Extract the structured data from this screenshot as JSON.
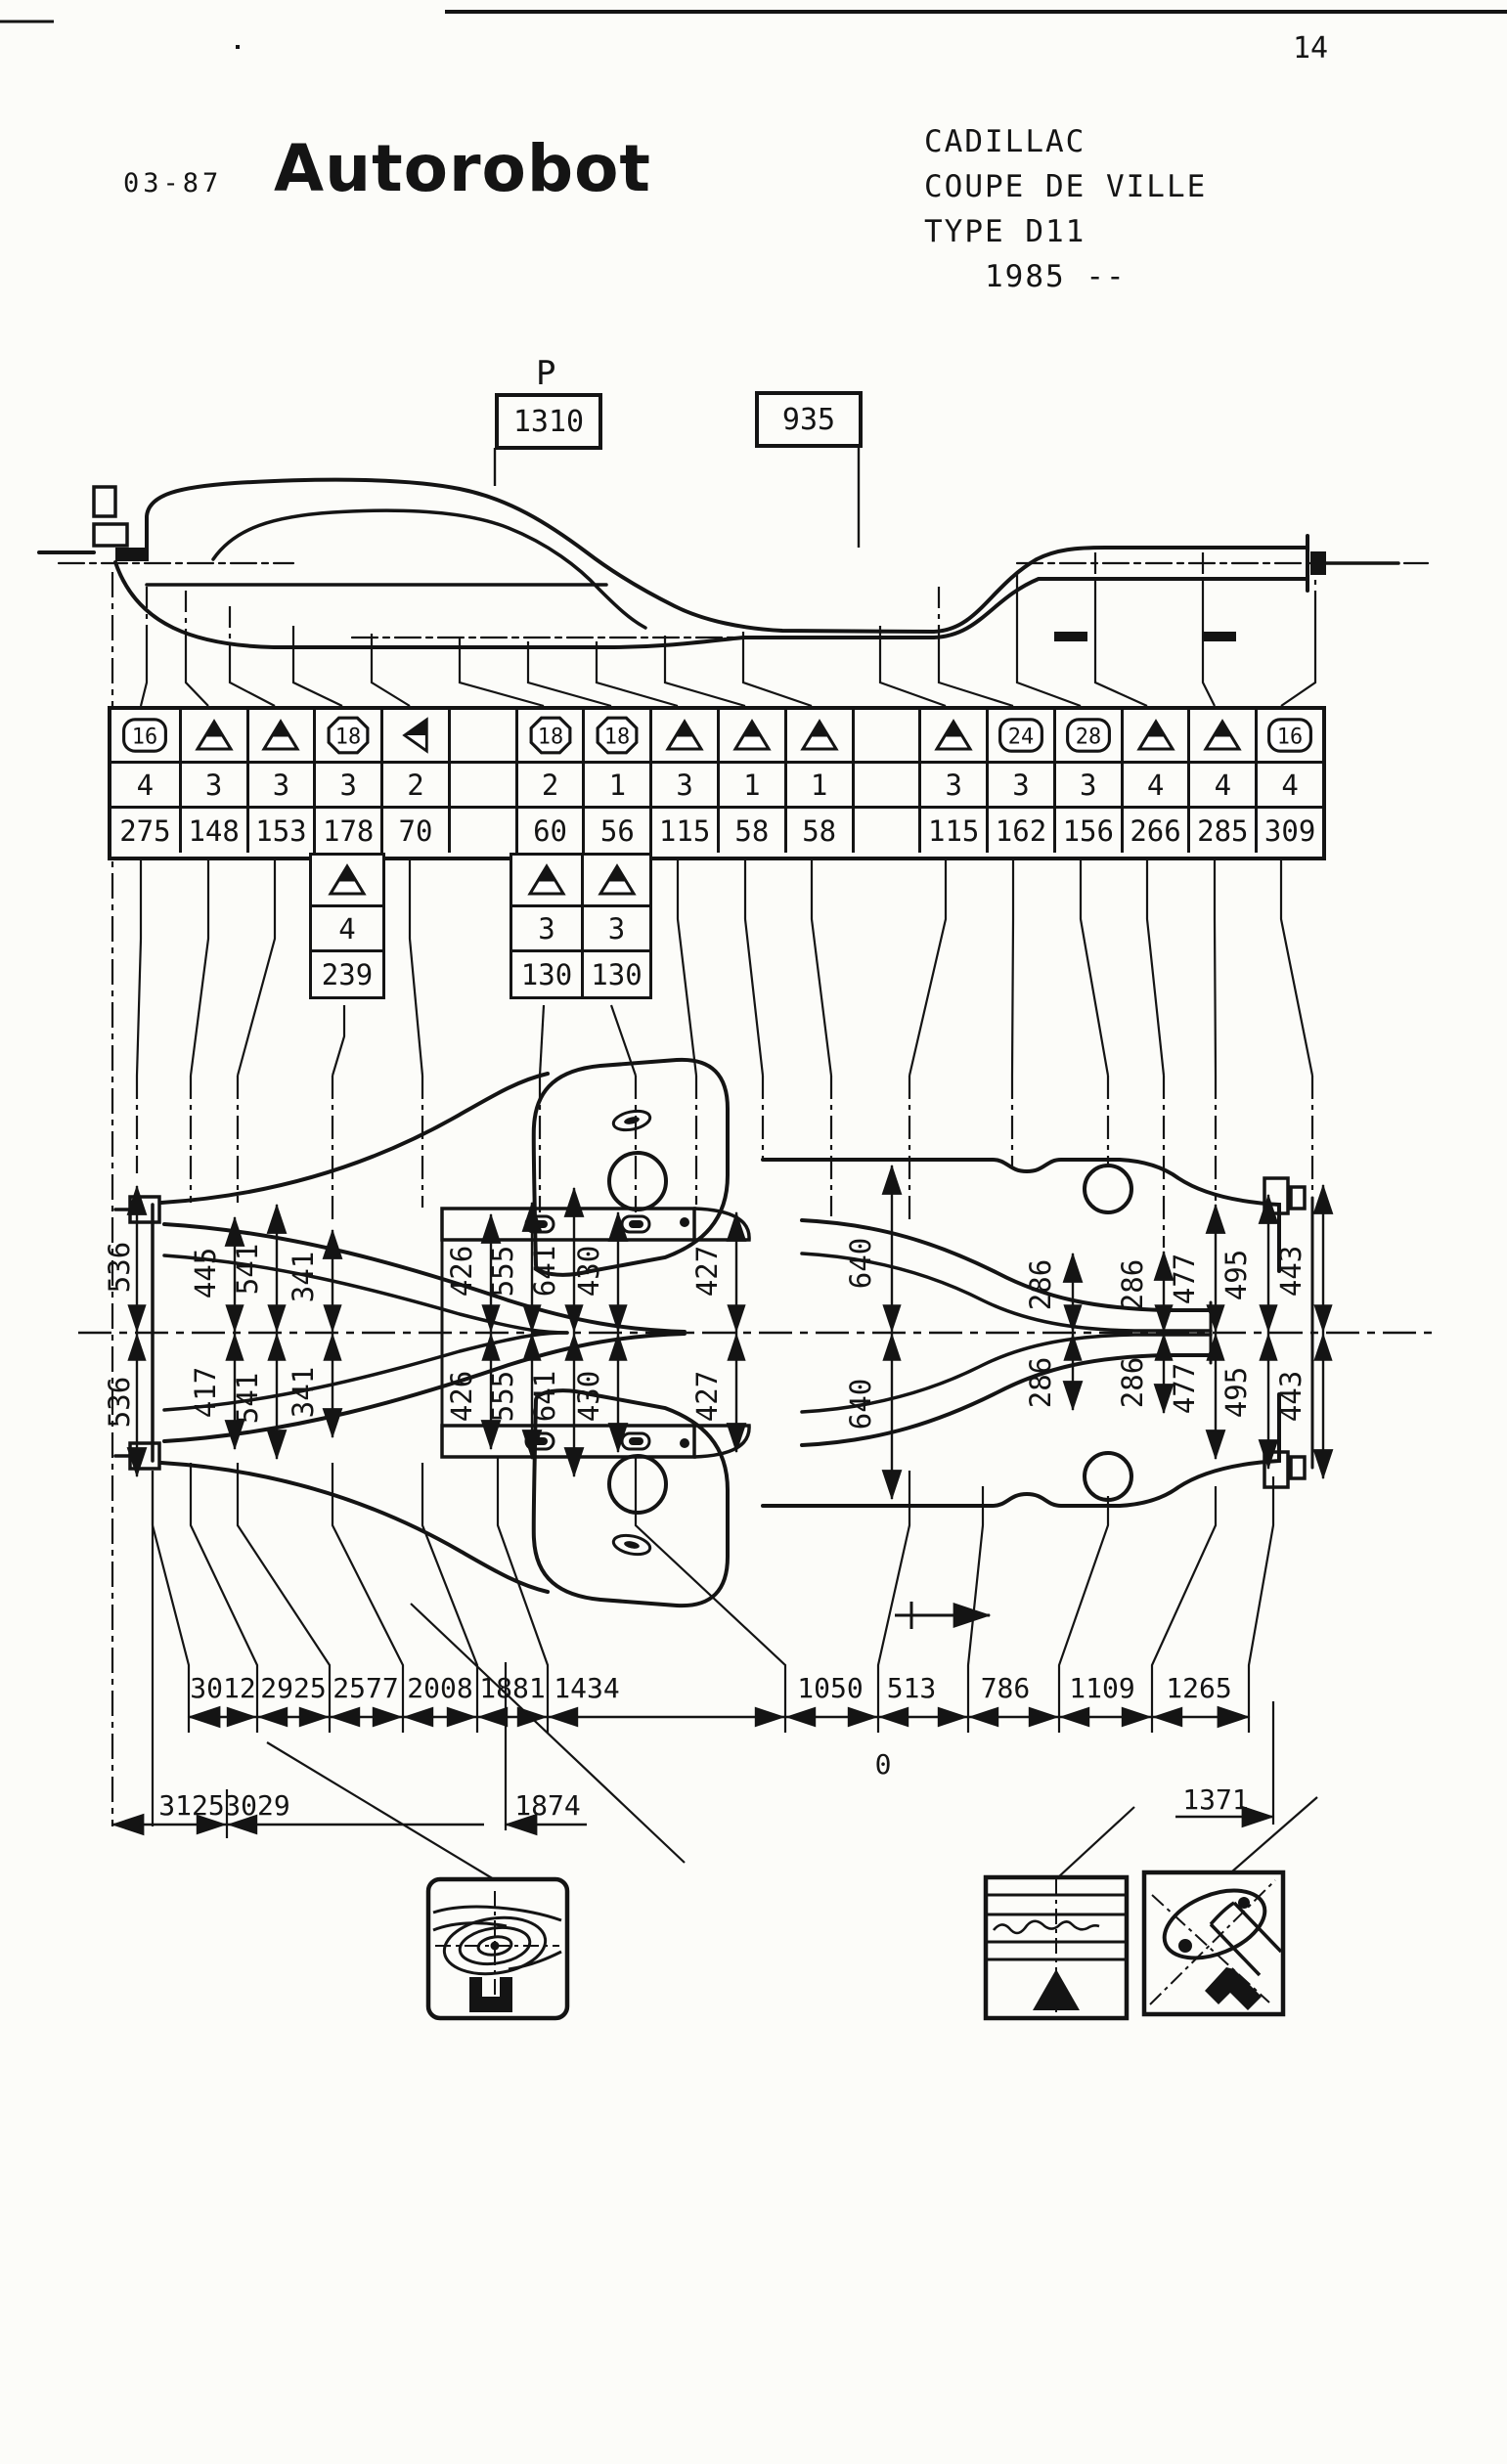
{
  "page": {
    "number": "14",
    "doc_code": "03-87",
    "brand": "Autorobot"
  },
  "vehicle": {
    "make": "CADILLAC",
    "model": "COUPE DE VILLE",
    "type": "TYPE D11",
    "year": "1985 --"
  },
  "side_view": {
    "p_label": "P",
    "box_left": "1310",
    "box_right": "935"
  },
  "main_table": {
    "columns": [
      {
        "shape": "plate",
        "symbol": "16",
        "count": "4",
        "value": "275"
      },
      {
        "shape": "triangle",
        "symbol": "",
        "count": "3",
        "value": "148"
      },
      {
        "shape": "triangle",
        "symbol": "",
        "count": "3",
        "value": "153"
      },
      {
        "shape": "octagon",
        "symbol": "18",
        "count": "3",
        "value": "178"
      },
      {
        "shape": "triangle-left",
        "symbol": "",
        "count": "2",
        "value": "70"
      },
      {
        "shape": "none",
        "symbol": "",
        "count": "",
        "value": ""
      },
      {
        "shape": "octagon",
        "symbol": "18",
        "count": "2",
        "value": "60"
      },
      {
        "shape": "octagon",
        "symbol": "18",
        "count": "1",
        "value": "56"
      },
      {
        "shape": "triangle",
        "symbol": "",
        "count": "3",
        "value": "115"
      },
      {
        "shape": "triangle",
        "symbol": "",
        "count": "1",
        "value": "58"
      },
      {
        "shape": "triangle",
        "symbol": "",
        "count": "1",
        "value": "58"
      },
      {
        "shape": "none",
        "symbol": "",
        "count": "",
        "value": ""
      },
      {
        "shape": "triangle",
        "symbol": "",
        "count": "3",
        "value": "115"
      },
      {
        "shape": "plate",
        "symbol": "24",
        "count": "3",
        "value": "162"
      },
      {
        "shape": "plate",
        "symbol": "28",
        "count": "3",
        "value": "156"
      },
      {
        "shape": "triangle",
        "symbol": "",
        "count": "4",
        "value": "266"
      },
      {
        "shape": "triangle",
        "symbol": "",
        "count": "4",
        "value": "285"
      },
      {
        "shape": "plate",
        "symbol": "16",
        "count": "4",
        "value": "309"
      }
    ]
  },
  "sub_tables": [
    {
      "columns": [
        {
          "shape": "triangle",
          "count": "4",
          "value": "239"
        }
      ]
    },
    {
      "columns": [
        {
          "shape": "triangle",
          "count": "3",
          "value": "130"
        },
        {
          "shape": "triangle",
          "count": "3",
          "value": "130"
        }
      ]
    }
  ],
  "plan_view": {
    "left_overall": [
      "536",
      "536"
    ],
    "front_widths_top": [
      "445",
      "541",
      "341"
    ],
    "front_widths_bottom": [
      "417",
      "541",
      "341"
    ],
    "mid_widths_top": [
      "426",
      "555",
      "641",
      "430",
      "427"
    ],
    "mid_widths_bottom": [
      "426",
      "555",
      "641",
      "430",
      "427"
    ],
    "rear_overall": [
      "640",
      "640"
    ],
    "rear_widths_top": [
      "286",
      "286",
      "477",
      "495",
      "443"
    ],
    "rear_widths_bottom": [
      "286",
      "286",
      "477",
      "495",
      "443"
    ]
  },
  "bottom_dims": {
    "lengths": [
      "3012",
      "2925",
      "2577",
      "2008",
      "1881",
      "1434",
      "1050",
      "513",
      "786",
      "1109",
      "1265"
    ],
    "overall_left": [
      "3125",
      "3029"
    ],
    "mid_ref": "1874",
    "datum_zero": "0",
    "rear_ref": "1371"
  },
  "icons": [
    "wheel-housing-gauge-icon",
    "sill-seam-gauge-icon",
    "rear-plate-clamp-icon"
  ]
}
